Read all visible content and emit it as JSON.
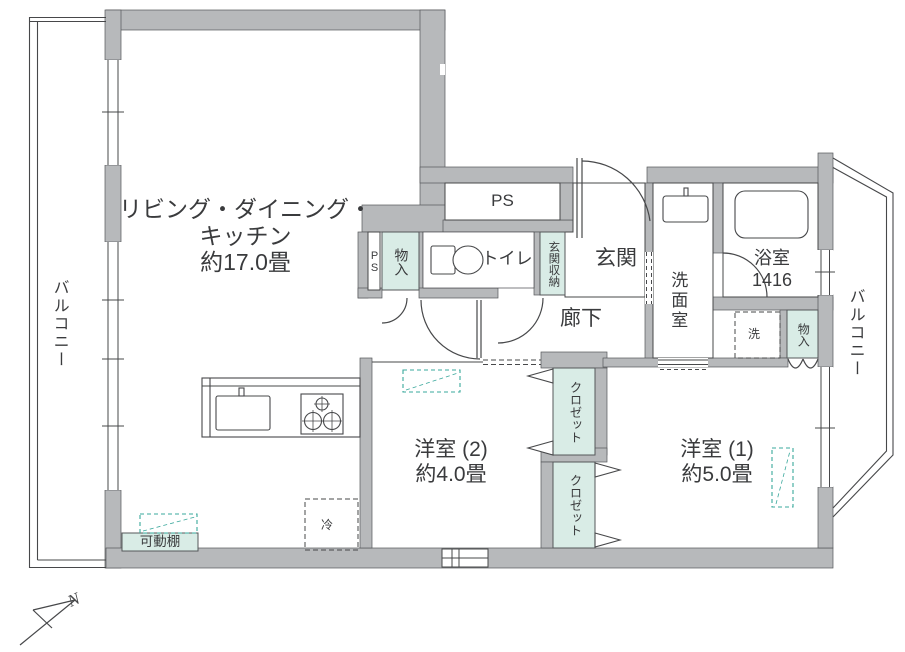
{
  "meta": {
    "type": "apartment-floor-plan"
  },
  "colors": {
    "wall_fill": "#b7b9bb",
    "wall_edge": "#55575a",
    "line": "#47484a",
    "storage_fill": "#d9ece6",
    "storage_edge": "#55575a",
    "equipment_dash": "#3aa89c",
    "text": "#3a3b3d",
    "background": "#ffffff"
  },
  "rooms": {
    "ldk": {
      "name_line1": "リビング・ダイニング・",
      "name_line2": "キッチン",
      "size": "約17.0畳"
    },
    "western1": {
      "name": "洋室 (1)",
      "size": "約5.0畳"
    },
    "western2": {
      "name": "洋室 (2)",
      "size": "約4.0畳"
    },
    "bathroom": {
      "name": "浴室",
      "size": "1416"
    },
    "washroom": {
      "name": "洗面室"
    },
    "toilet": {
      "name": "トイレ"
    },
    "entrance": {
      "name": "玄関"
    },
    "entrance_storage": {
      "name": "玄関収納"
    },
    "hallway": {
      "name": "廊下"
    },
    "balcony_left": {
      "name": "バルコニー"
    },
    "balcony_right": {
      "name": "バルコニー"
    },
    "storage_hall": {
      "name": "物入"
    },
    "storage_bath": {
      "name": "物入"
    },
    "closet_top": {
      "name": "クロゼット"
    },
    "closet_bottom": {
      "name": "クロゼット"
    },
    "pipe_space_large": {
      "name": "PS"
    },
    "pipe_space_small": {
      "name": "PS"
    },
    "refrigerator": {
      "name": "冷"
    },
    "washer": {
      "name": "洗"
    },
    "movable_shelf": {
      "name": "可動棚"
    },
    "compass": {
      "north": "N"
    }
  }
}
